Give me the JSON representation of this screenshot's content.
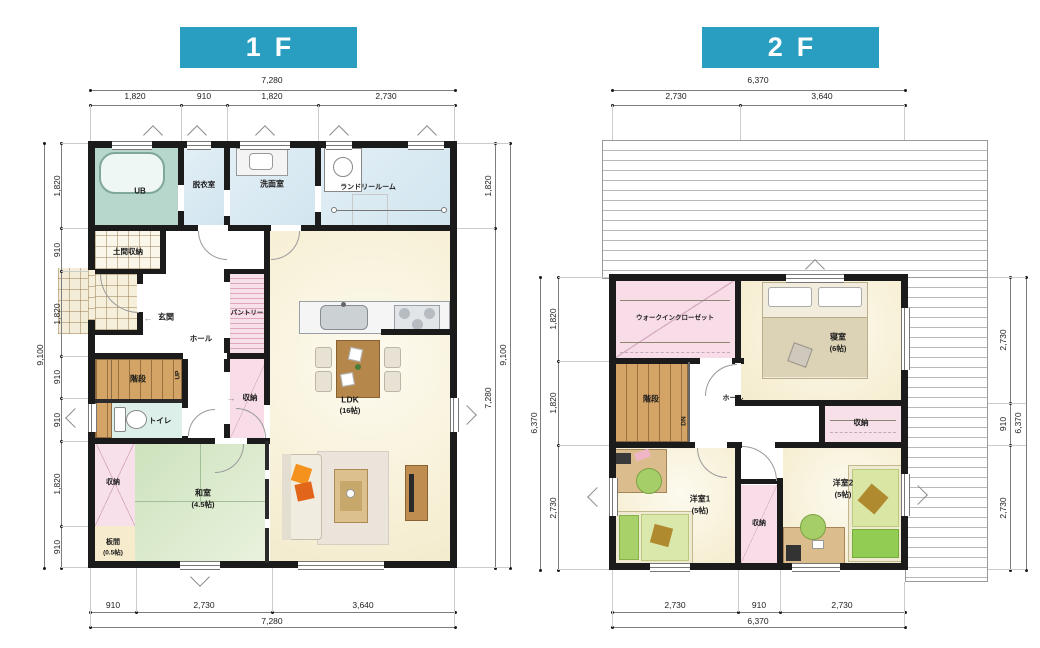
{
  "floor1": {
    "title": "1F",
    "rooms": {
      "ub": "UB",
      "dressing": "脱衣室",
      "washroom": "洗面室",
      "laundry": "ランドリールーム",
      "doma": "土間収納",
      "genkan": "玄関",
      "hall": "ホール",
      "pantry": "パントリー",
      "stairs": "階段",
      "up": "UP",
      "closet_hall": "収納",
      "toilet": "トイレ",
      "ldk": "LDK",
      "ldk_size": "(16帖)",
      "closet_sw": "収納",
      "washitsu": "和室",
      "washitsu_size": "(4.5帖)",
      "itama": "板間",
      "itama_size": "(0.5帖)"
    },
    "dims": {
      "top_total": "7,280",
      "top_segments": [
        "1,820",
        "910",
        "1,820",
        "2,730"
      ],
      "left_total": "9,100",
      "left_segments": [
        "1,820",
        "910",
        "1,820",
        "910",
        "910",
        "1,820",
        "910"
      ],
      "right_total": "9,100",
      "right_segments": [
        "1,820",
        "7,280"
      ],
      "bottom_total": "7,280",
      "bottom_segments": [
        "910",
        "2,730",
        "3,640"
      ]
    }
  },
  "floor2": {
    "title": "2F",
    "rooms": {
      "wic": "ウォークインクローゼット",
      "bedroom": "寝室",
      "bedroom_size": "(6帖)",
      "stairs": "階段",
      "dn": "DN",
      "hall": "ホール",
      "closet_east": "収納",
      "west1": "洋室1",
      "west1_size": "(5帖)",
      "closet_center": "収納",
      "west2": "洋室2",
      "west2_size": "(5帖)"
    },
    "dims": {
      "top_total": "6,370",
      "top_segments": [
        "2,730",
        "3,640"
      ],
      "left_total": "6,370",
      "left_segments": [
        "1,820",
        "1,820",
        "2,730"
      ],
      "right_total": "6,370",
      "right_segments": [
        "2,730",
        "910",
        "2,730"
      ],
      "bottom_total": "6,370",
      "bottom_segments": [
        "2,730",
        "910",
        "2,730"
      ]
    }
  },
  "icons": {
    "arrow_left": "←",
    "arrow_right": "→",
    "arrow_up": "↑",
    "arrow_down": "↓"
  },
  "colors": {
    "accent": "#2a9ec0",
    "wall": "#1b1b1b",
    "water_blue": "#d9e9f2",
    "bath_teal": "#b7d7cc",
    "cream": "#f8f2d9",
    "pink": "#f8e0ea",
    "stair_wood": "#d3a465",
    "tatami_green": "#d5e5c4",
    "furniture_wood": "#b5874a",
    "sofa_orange": "#f08a1e"
  }
}
